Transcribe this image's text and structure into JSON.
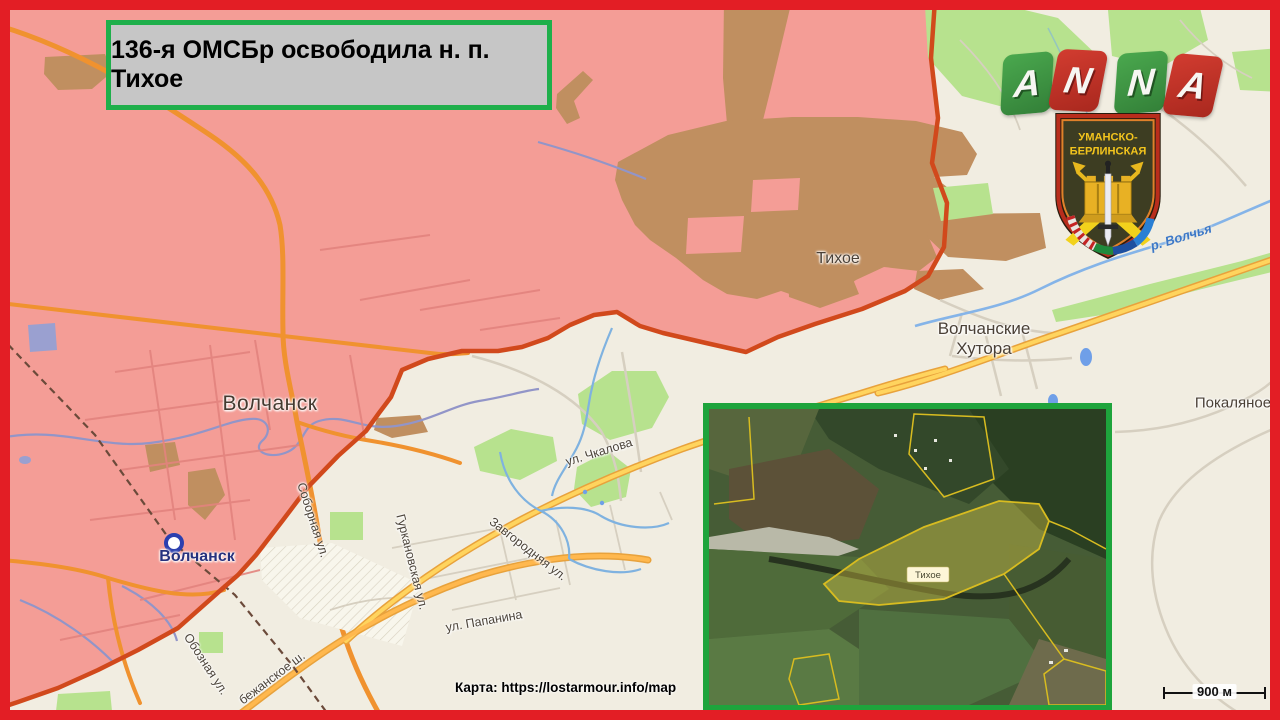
{
  "banner": {
    "text": "136-я ОМСБр освободила н. п. Тихое"
  },
  "logo": {
    "letters": [
      "A",
      "N",
      "N",
      "A"
    ]
  },
  "emblem": {
    "line1": "УМАНСКО-",
    "line2": "БЕРЛИНСКАЯ"
  },
  "map": {
    "labels": {
      "tihoe": "Тихое",
      "volchansk": "Волчанск",
      "volchansk_small": "Волчанск",
      "hutora_line1": "Волчанские",
      "hutora_line2": "Хутора",
      "pokalyanoe": "Покаляное",
      "river": "р. Волчья",
      "chkalova": "ул. Чкалова",
      "sobornaya": "Соборная ул.",
      "gurkanovskaya": "Гуркановская ул.",
      "zavgorodnyaya": "Завгородняя ул.",
      "papanina": "ул. Папанина",
      "oboznaya": "Обозная ул.",
      "bezhanskoe": "бежанское ш."
    }
  },
  "inset": {
    "label": "Тихое"
  },
  "credit": {
    "text": "Карта: https://lostarmour.info/map"
  },
  "scalebar": {
    "label": "900 м"
  },
  "colors": {
    "frame": "#e31e25",
    "banner_border": "#1faf4b",
    "banner_bg": "#c6c6c6",
    "map_bg": "#f1ede1",
    "zone_fill": "#f49d96",
    "zone_border": "#d1491c",
    "inset_border": "#1ea43c",
    "logo_green": "#3d9b41",
    "logo_red": "#c5372c",
    "forest_green": "#b7e28e",
    "road_yellow": "#ffd45e",
    "road_orange": "#f0922f"
  }
}
